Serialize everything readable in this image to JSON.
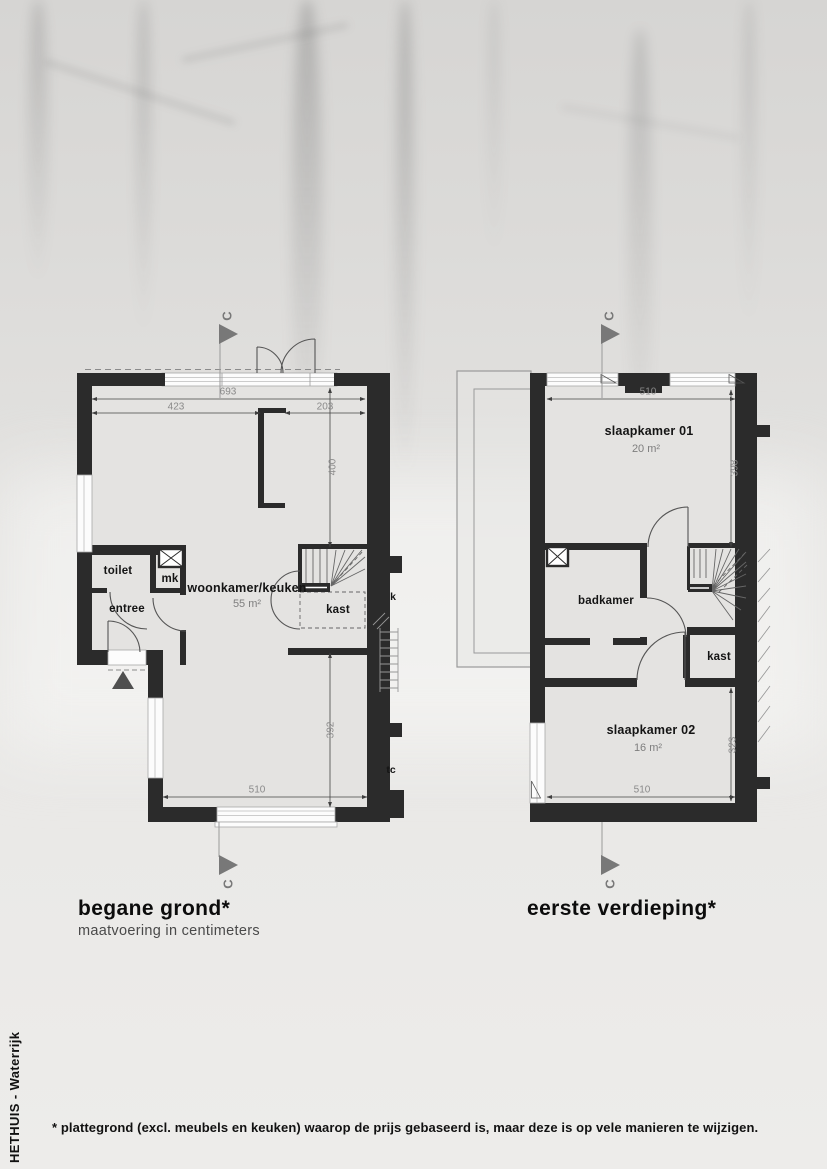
{
  "page": {
    "brand_vertical": "HETHUIS - Waterrijk",
    "footnote": "* plattegrond (excl. meubels en keuken) waarop de prijs gebaseerd is, maar deze is op vele manieren te wijzigen."
  },
  "colors": {
    "wall": "#2b2b2b",
    "floor_fill": "#e4e3e1",
    "dimension_text": "#8a8a8a",
    "marker_gray": "#777777",
    "label_black": "#141414"
  },
  "ground_floor": {
    "title": "begane grond*",
    "subtitle": "maatvoering in centimeters",
    "section_marker_top": "C",
    "section_marker_bottom": "C",
    "rooms": {
      "toilet": "toilet",
      "mk": "mk",
      "entree": "entree",
      "living_kitchen": "woonkamer/keuken",
      "living_kitchen_area": "55 m²",
      "kast": "kast"
    },
    "dimensions": {
      "total_width": "693",
      "front_width_left": "423",
      "front_width_right": "203",
      "living_depth": "400",
      "rear_depth": "392",
      "rear_width": "510"
    },
    "neighbor_labels": {
      "kast_partial": "k",
      "toilet_partial": "tc"
    }
  },
  "first_floor": {
    "title": "eerste verdieping*",
    "section_marker_top": "C",
    "section_marker_bottom": "C",
    "rooms": {
      "bedroom_01": "slaapkamer 01",
      "bedroom_01_area": "20 m²",
      "bathroom": "badkamer",
      "kast": "kast",
      "bedroom_02": "slaapkamer 02",
      "bedroom_02_area": "16 m²"
    },
    "dimensions": {
      "front_width": "510",
      "front_depth": "398",
      "rear_depth": "323",
      "rear_width": "510"
    }
  }
}
